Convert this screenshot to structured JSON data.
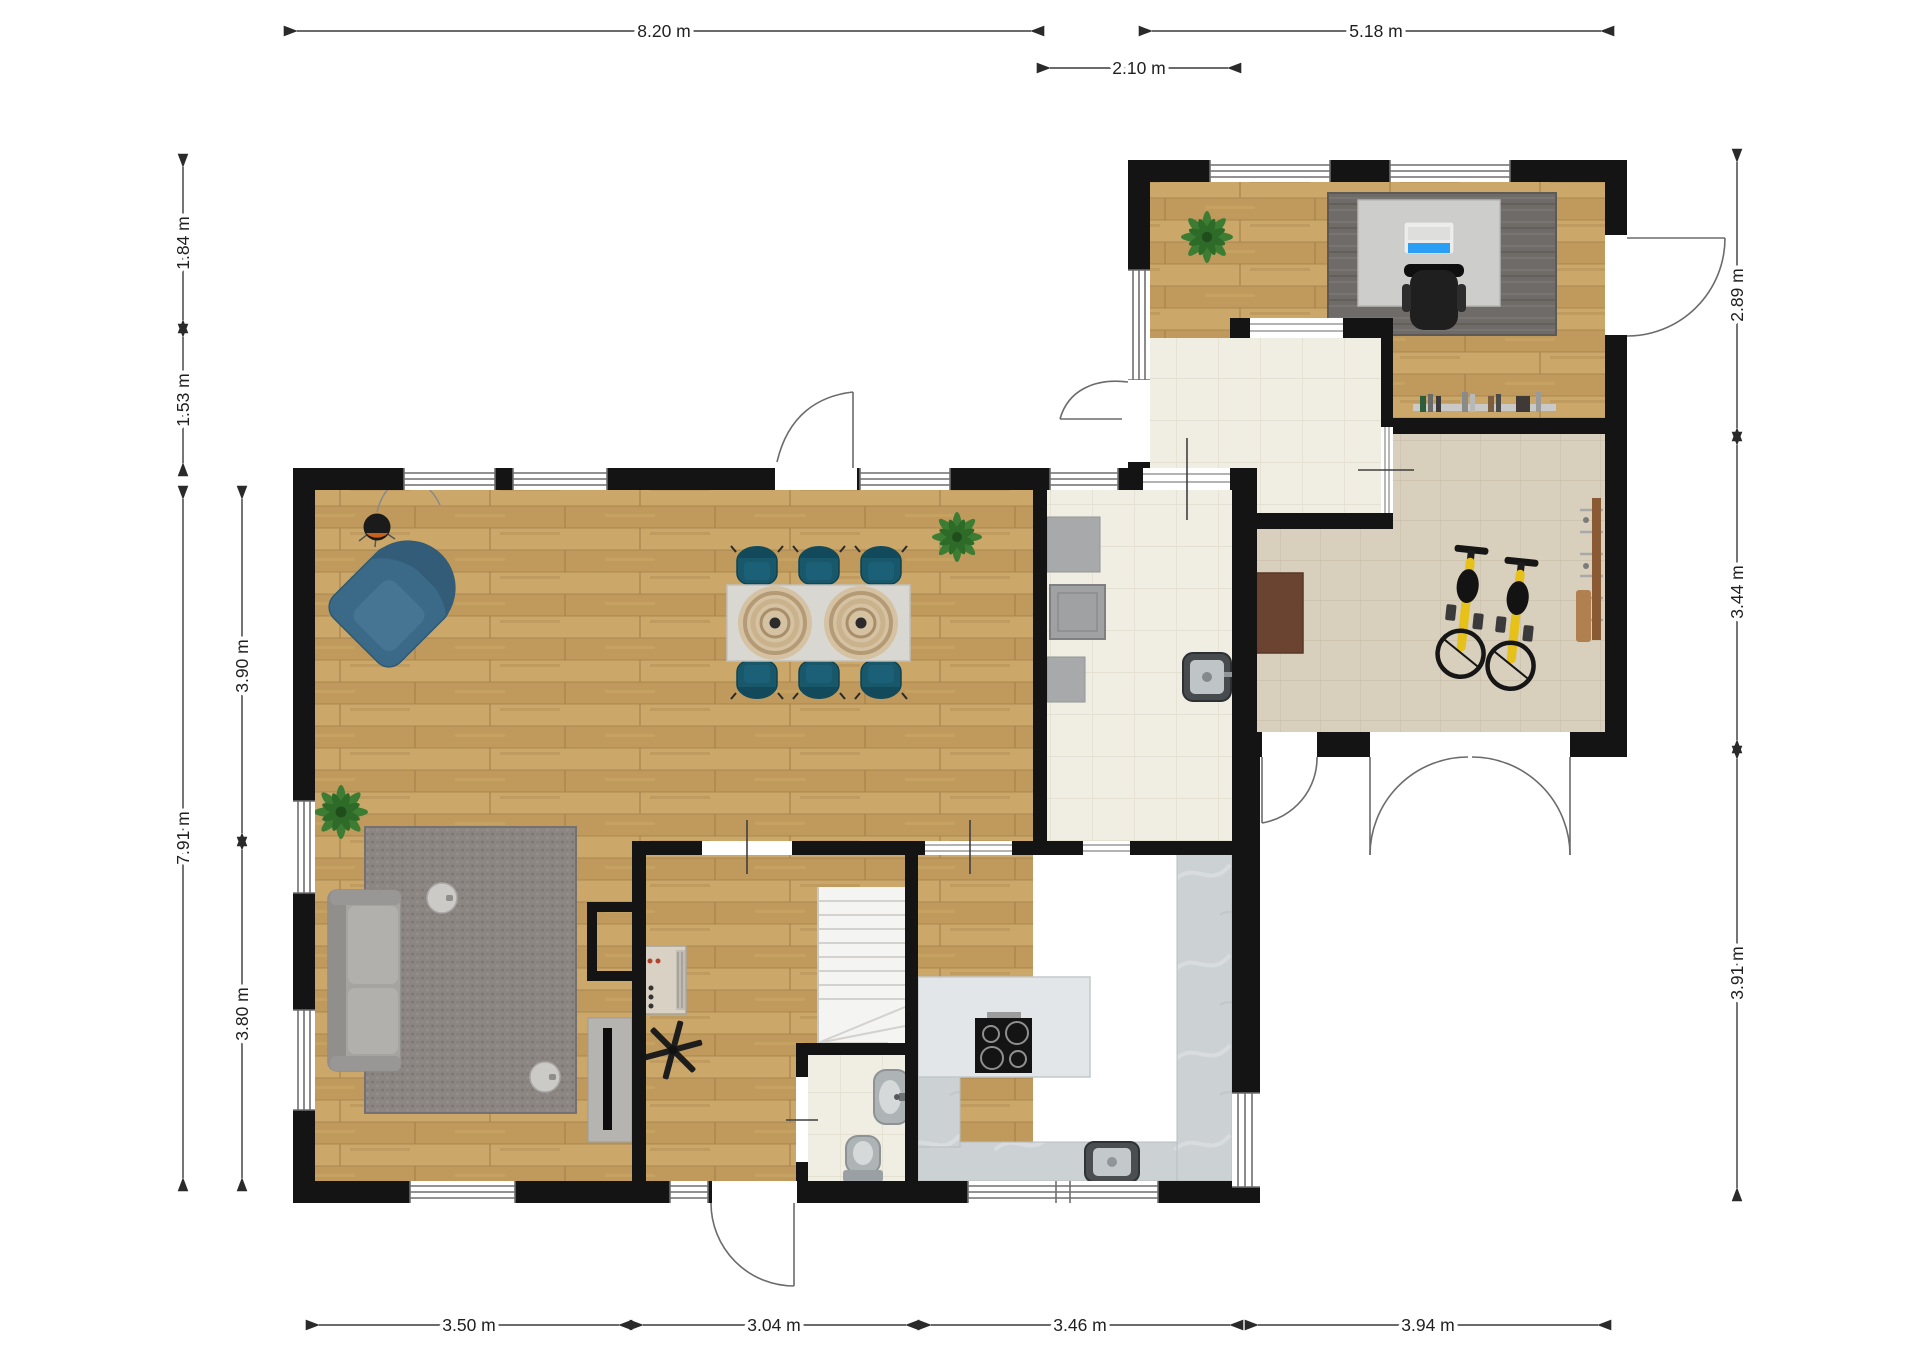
{
  "title": "2D floor plan with dimensions",
  "unit": "m",
  "dimensions": {
    "top": [
      {
        "name": "main-building-width",
        "label": "8.20 m"
      },
      {
        "name": "annex-width",
        "label": "5.18 m"
      },
      {
        "name": "utility-link-width",
        "label": "2.10 m"
      }
    ],
    "left": [
      {
        "name": "annex-top-offset",
        "label": "1.84 m"
      },
      {
        "name": "annex-to-main-offset",
        "label": "1.53 m"
      },
      {
        "name": "main-building-depth",
        "label": "7.91 m"
      },
      {
        "name": "living-dining-depth",
        "label": "3.90 m"
      },
      {
        "name": "lower-rooms-depth",
        "label": "3.80 m"
      }
    ],
    "right": [
      {
        "name": "office-depth",
        "label": "2.89 m"
      },
      {
        "name": "gym-depth",
        "label": "3.44 m"
      },
      {
        "name": "lower-right-depth",
        "label": "3.91 m"
      }
    ],
    "bottom": [
      {
        "name": "living-width",
        "label": "3.50 m"
      },
      {
        "name": "hall-width",
        "label": "3.04 m"
      },
      {
        "name": "kitchen-width",
        "label": "3.46 m"
      },
      {
        "name": "gym-width",
        "label": "3.94 m"
      }
    ]
  },
  "palette": {
    "wall": "#141414",
    "wood_floor": "#c6a164",
    "tile_cream": "#f0ede2",
    "tile_gym": "#d8cfbc",
    "marble_counter": "#ccd1d4",
    "rug_gray": "#8c8683",
    "rug_office": "#6e6b68",
    "sofa_gray": "#a5a4a1",
    "armchair_blue": "#3e6d8a",
    "dining_chair_teal": "#19586a",
    "exercise_bike_yellow": "#e6c119",
    "plant_green": "#3c7d33",
    "gym_mat_brown": "#6a4331",
    "laptop_screen_blue": "#2a9df4"
  },
  "furniture_icons": [
    "pendant-lamp-icon",
    "corner-armchair-icon",
    "dining-table-icon",
    "dining-chair-icon",
    "round-rug-icon",
    "plant-icon",
    "sofa-icon",
    "side-table-icon",
    "tv-icon",
    "ceiling-fan-icon",
    "fireplace-icon",
    "stairs-icon",
    "toilet-icon",
    "washbasin-icon",
    "kitchen-island-icon",
    "cooktop-icon",
    "kitchen-sink-icon",
    "counter-icon",
    "utility-sink-icon",
    "desk-icon",
    "laptop-icon",
    "office-chair-icon",
    "bookshelf-icon",
    "exercise-bike-icon",
    "gym-mat-icon",
    "wall-bars-icon",
    "window-icon",
    "door-swing-icon"
  ]
}
